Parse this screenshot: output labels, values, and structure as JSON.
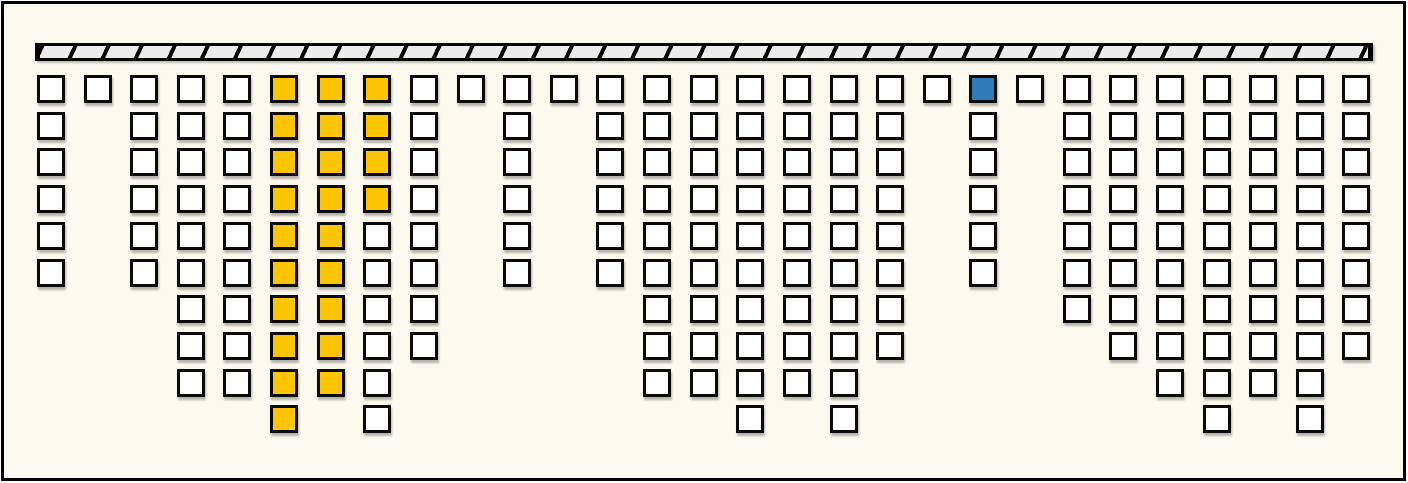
{
  "palette": {
    "background": "#FCFAEE",
    "frame_border": "#000000",
    "cell_border": "#0A0A0A",
    "cell_white": "#FFFFFF",
    "cell_yellow": "#FDC500",
    "cell_blue": "#2E7CB9",
    "hatch_fill": "#EBEBEB",
    "hatch_line": "#050505"
  },
  "timeline_bar": {
    "segments": 40
  },
  "cell_states": {
    "w": "white",
    "y": "yellow",
    "b": "blue"
  },
  "grid": {
    "columns": [
      {
        "cells": [
          "w",
          "w",
          "w",
          "w",
          "w",
          "w"
        ]
      },
      {
        "cells": [
          "w"
        ]
      },
      {
        "cells": [
          "w",
          "w",
          "w",
          "w",
          "w",
          "w"
        ]
      },
      {
        "cells": [
          "w",
          "w",
          "w",
          "w",
          "w",
          "w",
          "w",
          "w",
          "w"
        ]
      },
      {
        "cells": [
          "w",
          "w",
          "w",
          "w",
          "w",
          "w",
          "w",
          "w",
          "w"
        ]
      },
      {
        "cells": [
          "y",
          "y",
          "y",
          "y",
          "y",
          "y",
          "y",
          "y",
          "y",
          "y"
        ]
      },
      {
        "cells": [
          "y",
          "y",
          "y",
          "y",
          "y",
          "y",
          "y",
          "y",
          "y"
        ]
      },
      {
        "cells": [
          "y",
          "y",
          "y",
          "y",
          "w",
          "w",
          "w",
          "w",
          "w",
          "w"
        ]
      },
      {
        "cells": [
          "w",
          "w",
          "w",
          "w",
          "w",
          "w",
          "w",
          "w"
        ]
      },
      {
        "cells": [
          "w"
        ]
      },
      {
        "cells": [
          "w",
          "w",
          "w",
          "w",
          "w",
          "w"
        ]
      },
      {
        "cells": [
          "w"
        ]
      },
      {
        "cells": [
          "w",
          "w",
          "w",
          "w",
          "w",
          "w"
        ]
      },
      {
        "cells": [
          "w",
          "w",
          "w",
          "w",
          "w",
          "w",
          "w",
          "w",
          "w"
        ]
      },
      {
        "cells": [
          "w",
          "w",
          "w",
          "w",
          "w",
          "w",
          "w",
          "w",
          "w"
        ]
      },
      {
        "cells": [
          "w",
          "w",
          "w",
          "w",
          "w",
          "w",
          "w",
          "w",
          "w",
          "w"
        ]
      },
      {
        "cells": [
          "w",
          "w",
          "w",
          "w",
          "w",
          "w",
          "w",
          "w",
          "w"
        ]
      },
      {
        "cells": [
          "w",
          "w",
          "w",
          "w",
          "w",
          "w",
          "w",
          "w",
          "w",
          "w"
        ]
      },
      {
        "cells": [
          "w",
          "w",
          "w",
          "w",
          "w",
          "w",
          "w",
          "w"
        ]
      },
      {
        "cells": [
          "w"
        ]
      },
      {
        "cells": [
          "b",
          "w",
          "w",
          "w",
          "w",
          "w"
        ]
      },
      {
        "cells": [
          "w"
        ]
      },
      {
        "cells": [
          "w",
          "w",
          "w",
          "w",
          "w",
          "w",
          "w"
        ]
      },
      {
        "cells": [
          "w",
          "w",
          "w",
          "w",
          "w",
          "w",
          "w",
          "w"
        ]
      },
      {
        "cells": [
          "w",
          "w",
          "w",
          "w",
          "w",
          "w",
          "w",
          "w",
          "w"
        ]
      },
      {
        "cells": [
          "w",
          "w",
          "w",
          "w",
          "w",
          "w",
          "w",
          "w",
          "w",
          "w"
        ]
      },
      {
        "cells": [
          "w",
          "w",
          "w",
          "w",
          "w",
          "w",
          "w",
          "w",
          "w"
        ]
      },
      {
        "cells": [
          "w",
          "w",
          "w",
          "w",
          "w",
          "w",
          "w",
          "w",
          "w",
          "w"
        ]
      },
      {
        "cells": [
          "w",
          "w",
          "w",
          "w",
          "w",
          "w",
          "w",
          "w"
        ]
      }
    ]
  }
}
